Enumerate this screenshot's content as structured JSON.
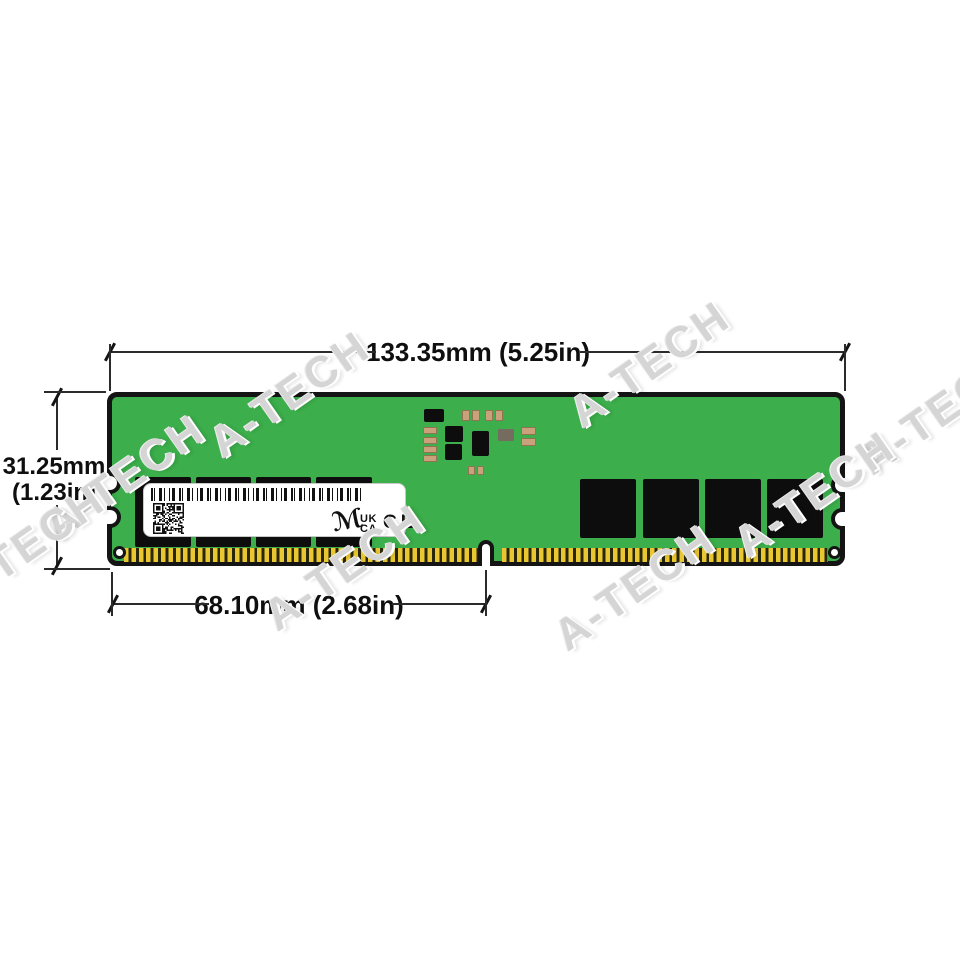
{
  "watermark": {
    "text": "A-TECH"
  },
  "dimensions": {
    "width_label": "133.35mm (5.25in)",
    "height_label_line1": "31.25mm",
    "height_label_line2": "(1.23in)",
    "pin_section_label": "68.10mm (2.68in)"
  },
  "module": {
    "label": {
      "brand_logo_glyph": "ℳ",
      "ukca_line1": "UK",
      "ukca_line2": "CA",
      "ce_mark": "CE"
    }
  },
  "colors": {
    "pcb_green": "#3cae4b",
    "chip_black": "#0d0d0d",
    "pin_gold": "#e9c733",
    "capacitor_tan": "#c9a27b",
    "label_white": "#ffffff",
    "dimension_line": "#2b2b2b",
    "watermark_gray": "#d5d5d5"
  }
}
